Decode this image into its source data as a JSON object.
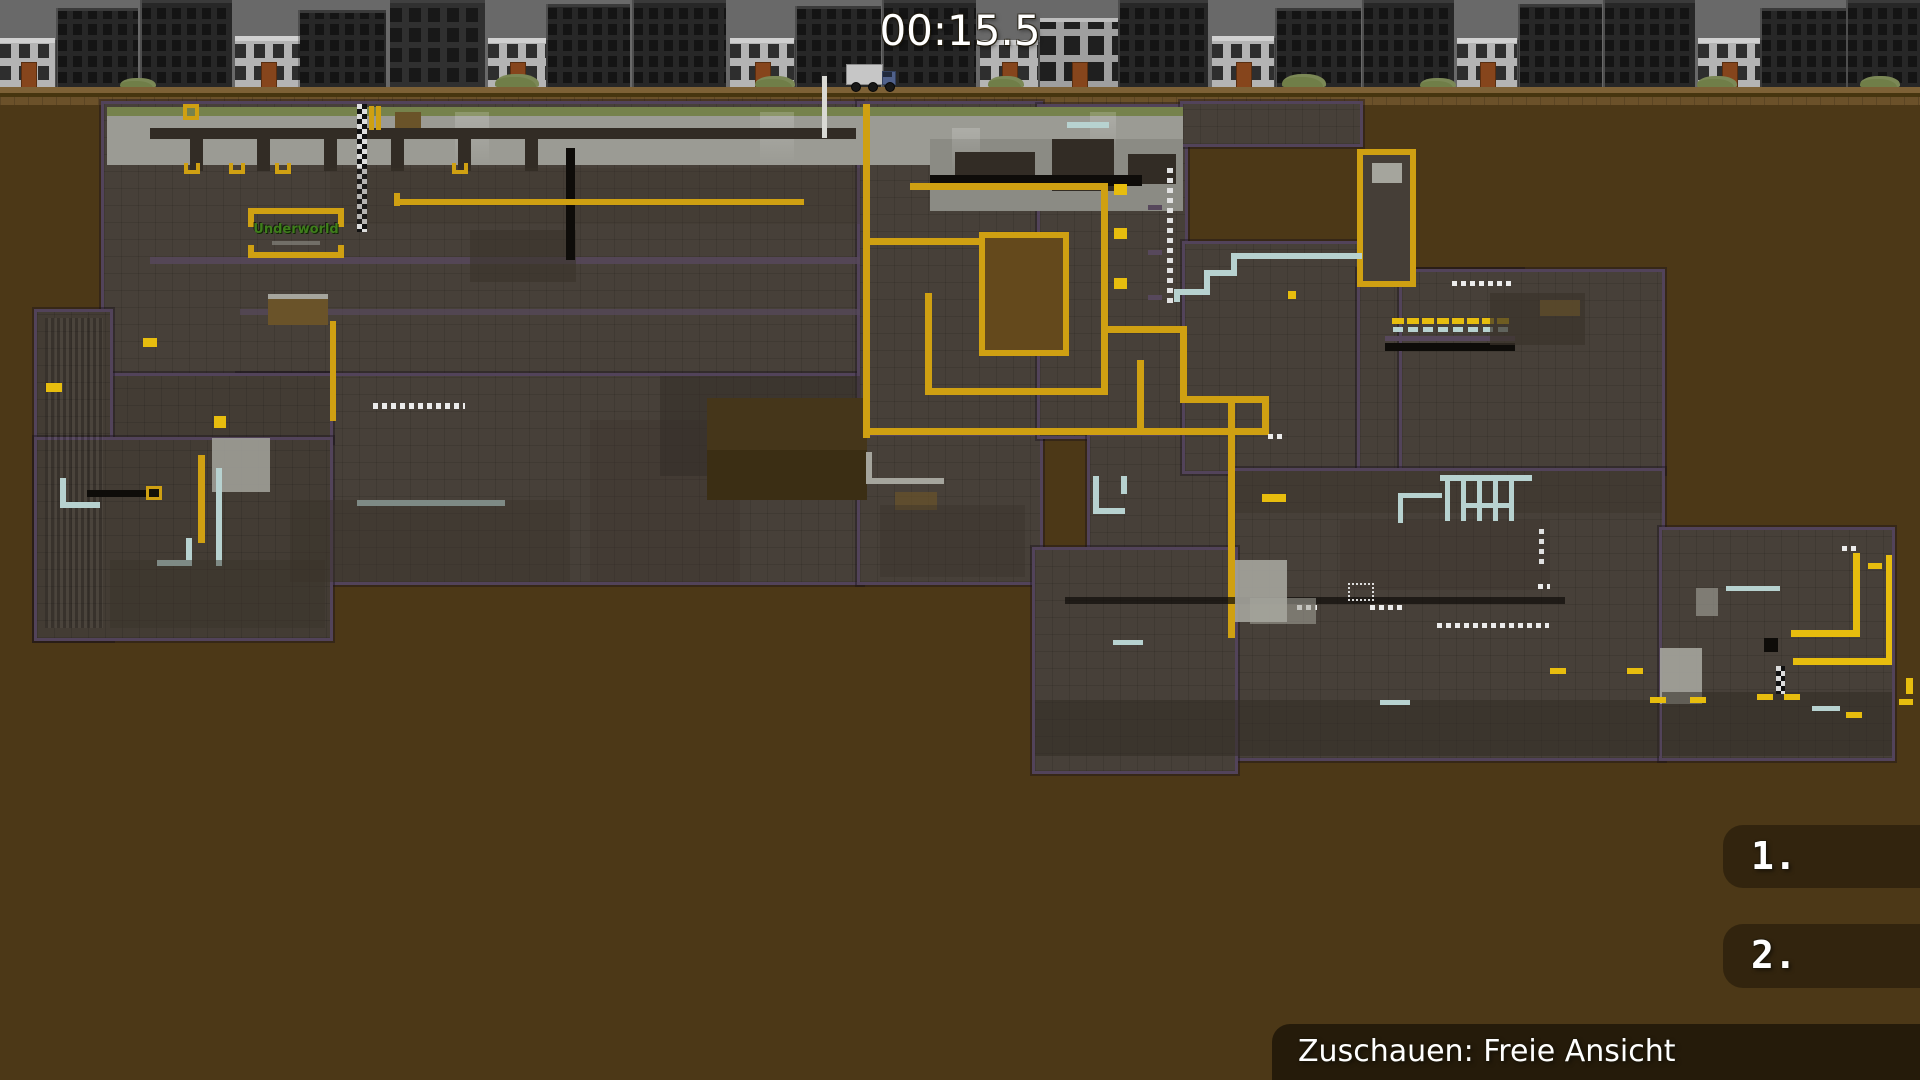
{
  "hud": {
    "timer": "00:15.5",
    "scoreboard": [
      {
        "rank": "1."
      },
      {
        "rank": "2."
      }
    ],
    "spectate_label": "Zuschauen: Freie Ansicht"
  },
  "colors": {
    "background": "#4c3817",
    "sky": "#696969",
    "map_fill": "#474039",
    "map_border": "#52435a",
    "accent_yellow": "#cfa012",
    "pipe_blue": "#b7d2d0",
    "surface_grey": "#9b9b94",
    "sign_green": "#3f7d1c",
    "hud_panel": "rgba(27,19,6,0.52)",
    "text": "#ffffff"
  },
  "map": {
    "sign_text": "Underworld",
    "buildings": [
      [
        0,
        55,
        50,
        "light"
      ],
      [
        58,
        80,
        80,
        "dark"
      ],
      [
        142,
        90,
        88,
        "dark"
      ],
      [
        235,
        66,
        52,
        "light"
      ],
      [
        300,
        86,
        78,
        "dark"
      ],
      [
        390,
        95,
        88,
        "darkwin"
      ],
      [
        488,
        58,
        50,
        "light"
      ],
      [
        548,
        82,
        84,
        "dark"
      ],
      [
        634,
        92,
        88,
        "dark"
      ],
      [
        730,
        64,
        50,
        "light"
      ],
      [
        797,
        84,
        82,
        "dark"
      ],
      [
        884,
        92,
        88,
        "dark"
      ],
      [
        980,
        58,
        48,
        "light"
      ],
      [
        1040,
        78,
        70,
        "light2"
      ],
      [
        1120,
        88,
        88,
        "dark"
      ],
      [
        1212,
        62,
        52,
        "light"
      ],
      [
        1277,
        84,
        80,
        "dark"
      ],
      [
        1364,
        90,
        88,
        "dark"
      ],
      [
        1457,
        60,
        50,
        "light"
      ],
      [
        1520,
        82,
        84,
        "dark"
      ],
      [
        1605,
        90,
        88,
        "dark"
      ],
      [
        1698,
        62,
        50,
        "light"
      ],
      [
        1762,
        84,
        80,
        "dark"
      ],
      [
        1848,
        72,
        88,
        "dark"
      ]
    ],
    "bushes": [
      [
        120,
        36,
        10
      ],
      [
        495,
        44,
        14
      ],
      [
        755,
        40,
        12
      ],
      [
        988,
        36,
        12
      ],
      [
        1282,
        44,
        14
      ],
      [
        1420,
        36,
        10
      ],
      [
        1697,
        40,
        12
      ],
      [
        1860,
        40,
        12
      ]
    ],
    "rects": [
      [
        104,
        104,
        756,
        272,
        "fill b"
      ],
      [
        240,
        376,
        620,
        206,
        "fill b"
      ],
      [
        110,
        376,
        220,
        64,
        "fill2 b"
      ],
      [
        37,
        312,
        73,
        326,
        "fill2 b"
      ],
      [
        37,
        440,
        293,
        198,
        "fill2 b"
      ],
      [
        860,
        104,
        180,
        332,
        "fill b"
      ],
      [
        860,
        436,
        180,
        146,
        "fill b"
      ],
      [
        1040,
        107,
        145,
        329,
        "fill b"
      ],
      [
        1090,
        436,
        145,
        114,
        "fill b"
      ],
      [
        1183,
        104,
        177,
        40,
        "fill b"
      ],
      [
        1185,
        244,
        175,
        227,
        "fill b"
      ],
      [
        1360,
        272,
        160,
        199,
        "fill b"
      ],
      [
        1402,
        272,
        260,
        199,
        "fill b"
      ],
      [
        1235,
        471,
        427,
        287,
        "fill b"
      ],
      [
        1662,
        530,
        230,
        228,
        "fill b"
      ],
      [
        1035,
        550,
        200,
        221,
        "fill b"
      ],
      [
        107,
        107,
        1076,
        58,
        "surface"
      ],
      [
        107,
        107,
        1076,
        9,
        "green"
      ],
      [
        930,
        139,
        253,
        72,
        "surfdim"
      ],
      [
        455,
        112,
        34,
        52,
        "glow"
      ],
      [
        760,
        112,
        34,
        52,
        "glow"
      ],
      [
        952,
        128,
        28,
        46,
        "glow"
      ],
      [
        1090,
        112,
        26,
        40,
        "glow"
      ],
      [
        150,
        128,
        706,
        11,
        "dark2"
      ],
      [
        190,
        139,
        13,
        32,
        "dark2"
      ],
      [
        257,
        139,
        13,
        32,
        "dark2"
      ],
      [
        324,
        139,
        13,
        32,
        "dark2"
      ],
      [
        391,
        139,
        13,
        32,
        "dark2"
      ],
      [
        458,
        139,
        13,
        32,
        "dark2"
      ],
      [
        525,
        139,
        13,
        32,
        "dark2"
      ],
      [
        955,
        152,
        80,
        34,
        "dark2"
      ],
      [
        1052,
        139,
        62,
        52,
        "dark2"
      ],
      [
        1128,
        154,
        48,
        30,
        "dark2"
      ],
      [
        930,
        175,
        212,
        11,
        "black"
      ],
      [
        357,
        104,
        10,
        128,
        "checker"
      ],
      [
        369,
        106,
        5,
        24,
        "yellow"
      ],
      [
        376,
        106,
        5,
        24,
        "yellow"
      ],
      [
        822,
        76,
        5,
        62,
        "white2"
      ],
      [
        183,
        104,
        16,
        16,
        "ysq"
      ],
      [
        395,
        112,
        26,
        16,
        "dirt2"
      ],
      [
        1067,
        122,
        42,
        6,
        "blue"
      ],
      [
        150,
        257,
        710,
        7,
        "purple2",
        0.85
      ],
      [
        240,
        309,
        620,
        6,
        "purple2",
        0.7
      ],
      [
        330,
        168,
        530,
        56,
        "dark",
        0.25
      ],
      [
        470,
        230,
        106,
        52,
        "dark",
        0.6
      ],
      [
        566,
        148,
        9,
        112,
        "black"
      ],
      [
        184,
        163,
        16,
        11,
        "uhook"
      ],
      [
        229,
        163,
        16,
        11,
        "uhook"
      ],
      [
        275,
        163,
        16,
        11,
        "uhook"
      ],
      [
        452,
        163,
        16,
        11,
        "uhook"
      ],
      [
        394,
        193,
        6,
        13,
        "yellow"
      ],
      [
        394,
        199,
        410,
        6,
        "yellow"
      ],
      [
        248,
        208,
        96,
        6,
        "yellow"
      ],
      [
        248,
        214,
        6,
        13,
        "yellow"
      ],
      [
        338,
        214,
        6,
        13,
        "yellow"
      ],
      [
        248,
        252,
        96,
        6,
        "yellow"
      ],
      [
        248,
        245,
        6,
        7,
        "yellow"
      ],
      [
        338,
        245,
        6,
        7,
        "yellow"
      ],
      [
        272,
        241,
        48,
        4,
        "grey2",
        0.6
      ],
      [
        268,
        294,
        60,
        5,
        "grey"
      ],
      [
        268,
        299,
        60,
        26,
        "dirt2"
      ],
      [
        330,
        321,
        6,
        100,
        "yellow"
      ],
      [
        373,
        403,
        92,
        6,
        "dotH"
      ],
      [
        45,
        318,
        58,
        310,
        "stripes",
        0.8
      ],
      [
        87,
        490,
        64,
        7,
        "black"
      ],
      [
        146,
        486,
        16,
        14,
        "ybox"
      ],
      [
        198,
        455,
        7,
        88,
        "yellow"
      ],
      [
        214,
        416,
        12,
        12,
        "ybright"
      ],
      [
        143,
        338,
        14,
        9,
        "ybright"
      ],
      [
        46,
        383,
        16,
        9,
        "ybright"
      ],
      [
        212,
        438,
        58,
        54,
        "grey",
        0.85
      ],
      [
        216,
        468,
        6,
        98,
        "blue"
      ],
      [
        186,
        538,
        6,
        28,
        "blue"
      ],
      [
        157,
        560,
        35,
        6,
        "blue"
      ],
      [
        357,
        500,
        148,
        6,
        "blue"
      ],
      [
        60,
        478,
        6,
        30,
        "blue"
      ],
      [
        60,
        502,
        40,
        6,
        "blue"
      ],
      [
        110,
        560,
        215,
        68,
        "dark",
        0.45
      ],
      [
        290,
        500,
        280,
        82,
        "dark",
        0.45
      ],
      [
        590,
        420,
        150,
        162,
        "dark",
        0.3
      ],
      [
        660,
        376,
        200,
        100,
        "dark2",
        0.5
      ],
      [
        707,
        398,
        160,
        102,
        "pit"
      ],
      [
        707,
        450,
        160,
        50,
        "pit2"
      ],
      [
        863,
        104,
        7,
        334,
        "yellow"
      ],
      [
        910,
        183,
        198,
        7,
        "yellow"
      ],
      [
        1101,
        183,
        7,
        212,
        "yellow"
      ],
      [
        925,
        388,
        183,
        7,
        "yellow"
      ],
      [
        925,
        293,
        7,
        100,
        "yellow"
      ],
      [
        868,
        238,
        120,
        7,
        "yellow"
      ],
      [
        985,
        238,
        78,
        112,
        "hole"
      ],
      [
        1114,
        184,
        13,
        11,
        "ybright"
      ],
      [
        1114,
        228,
        13,
        11,
        "ybright"
      ],
      [
        1114,
        278,
        13,
        11,
        "ybright"
      ],
      [
        1148,
        205,
        14,
        5,
        "purple2"
      ],
      [
        1148,
        250,
        14,
        5,
        "purple2"
      ],
      [
        1148,
        295,
        14,
        5,
        "purple2"
      ],
      [
        1167,
        167,
        6,
        136,
        "dotV"
      ],
      [
        868,
        428,
        401,
        7,
        "yellow"
      ],
      [
        1228,
        400,
        7,
        238,
        "yellow"
      ],
      [
        1105,
        326,
        82,
        7,
        "yellow"
      ],
      [
        1180,
        326,
        7,
        77,
        "yellow"
      ],
      [
        1180,
        396,
        88,
        7,
        "yellow"
      ],
      [
        1262,
        396,
        7,
        38,
        "yellow"
      ],
      [
        1137,
        360,
        7,
        75,
        "yellow"
      ],
      [
        866,
        452,
        6,
        32,
        "grey"
      ],
      [
        866,
        478,
        78,
        6,
        "grey"
      ],
      [
        895,
        492,
        42,
        18,
        "dirt2",
        0.7
      ],
      [
        880,
        505,
        145,
        72,
        "dark",
        0.4
      ],
      [
        1363,
        155,
        47,
        126,
        "tower"
      ],
      [
        1372,
        163,
        30,
        20,
        "grey"
      ],
      [
        1237,
        253,
        125,
        6,
        "blue"
      ],
      [
        1231,
        253,
        6,
        22,
        "blue"
      ],
      [
        1204,
        270,
        33,
        6,
        "blue"
      ],
      [
        1204,
        270,
        6,
        24,
        "blue"
      ],
      [
        1174,
        289,
        36,
        6,
        "blue"
      ],
      [
        1174,
        289,
        6,
        13,
        "blue"
      ],
      [
        1288,
        291,
        8,
        8,
        "ybright"
      ],
      [
        1392,
        318,
        12,
        6,
        "ybright"
      ],
      [
        1407,
        318,
        12,
        6,
        "ybright"
      ],
      [
        1422,
        318,
        12,
        6,
        "ybright"
      ],
      [
        1437,
        318,
        12,
        6,
        "ybright"
      ],
      [
        1452,
        318,
        12,
        6,
        "ybright"
      ],
      [
        1467,
        318,
        12,
        6,
        "ybright"
      ],
      [
        1482,
        318,
        12,
        6,
        "ybright"
      ],
      [
        1497,
        318,
        12,
        6,
        "ybright"
      ],
      [
        1393,
        327,
        10,
        5,
        "blue"
      ],
      [
        1408,
        327,
        10,
        5,
        "blue"
      ],
      [
        1423,
        327,
        10,
        5,
        "blue"
      ],
      [
        1438,
        327,
        10,
        5,
        "blue"
      ],
      [
        1453,
        327,
        10,
        5,
        "blue"
      ],
      [
        1468,
        327,
        10,
        5,
        "blue"
      ],
      [
        1483,
        327,
        10,
        5,
        "blue"
      ],
      [
        1498,
        327,
        10,
        5,
        "blue"
      ],
      [
        1385,
        336,
        130,
        5,
        "purple2"
      ],
      [
        1385,
        343,
        130,
        8,
        "black"
      ],
      [
        1452,
        281,
        62,
        5,
        "dotH"
      ],
      [
        1490,
        293,
        95,
        52,
        "dark",
        0.7
      ],
      [
        1540,
        300,
        40,
        16,
        "dirt2",
        0.6
      ],
      [
        1235,
        471,
        427,
        42,
        "dark",
        0.45
      ],
      [
        1340,
        520,
        210,
        70,
        "dark",
        0.3
      ],
      [
        1065,
        597,
        500,
        7,
        "black",
        0.7
      ],
      [
        1437,
        623,
        112,
        5,
        "dotH"
      ],
      [
        1297,
        605,
        20,
        5,
        "dotH"
      ],
      [
        1370,
        605,
        32,
        5,
        "dotH"
      ],
      [
        1539,
        528,
        5,
        36,
        "dotV"
      ],
      [
        1842,
        546,
        14,
        5,
        "dotH"
      ],
      [
        1538,
        584,
        12,
        5,
        "dotH"
      ],
      [
        1268,
        434,
        16,
        5,
        "dotH"
      ],
      [
        1235,
        560,
        52,
        62,
        "grey",
        0.9
      ],
      [
        1250,
        598,
        66,
        26,
        "grey",
        0.55
      ],
      [
        1660,
        648,
        42,
        56,
        "grey",
        0.9
      ],
      [
        1696,
        588,
        22,
        28,
        "grey",
        0.6
      ],
      [
        1035,
        700,
        625,
        56,
        "dark2",
        0.55
      ],
      [
        1662,
        692,
        230,
        64,
        "dark2",
        0.55
      ],
      [
        1776,
        666,
        9,
        28,
        "checker"
      ],
      [
        1853,
        553,
        7,
        84,
        "ybright"
      ],
      [
        1791,
        630,
        69,
        7,
        "ybright"
      ],
      [
        1886,
        555,
        6,
        110,
        "ybright"
      ],
      [
        1793,
        658,
        99,
        7,
        "ybright"
      ],
      [
        1550,
        668,
        16,
        6,
        "ybright"
      ],
      [
        1627,
        668,
        16,
        6,
        "ybright"
      ],
      [
        1650,
        697,
        16,
        6,
        "ybright"
      ],
      [
        1690,
        697,
        16,
        6,
        "ybright"
      ],
      [
        1757,
        694,
        16,
        6,
        "ybright"
      ],
      [
        1784,
        694,
        16,
        6,
        "ybright"
      ],
      [
        1846,
        712,
        16,
        6,
        "ybright"
      ],
      [
        1899,
        699,
        14,
        6,
        "ybright"
      ],
      [
        1906,
        678,
        7,
        16,
        "ybright"
      ],
      [
        1868,
        563,
        14,
        6,
        "ybright"
      ],
      [
        1726,
        586,
        54,
        5,
        "blue"
      ],
      [
        1812,
        706,
        28,
        5,
        "blue"
      ],
      [
        1380,
        700,
        30,
        5,
        "blue"
      ],
      [
        1113,
        640,
        30,
        5,
        "blue"
      ],
      [
        1440,
        475,
        92,
        6,
        "blue"
      ],
      [
        1445,
        481,
        5,
        40,
        "blue"
      ],
      [
        1461,
        481,
        5,
        40,
        "blue"
      ],
      [
        1477,
        481,
        5,
        40,
        "blue"
      ],
      [
        1493,
        481,
        5,
        40,
        "blue"
      ],
      [
        1509,
        481,
        5,
        40,
        "blue"
      ],
      [
        1461,
        503,
        53,
        5,
        "blue"
      ],
      [
        1398,
        493,
        44,
        5,
        "blue"
      ],
      [
        1398,
        493,
        5,
        30,
        "blue"
      ],
      [
        1764,
        638,
        14,
        14,
        "black"
      ],
      [
        1348,
        583,
        26,
        18,
        "frame"
      ],
      [
        1262,
        494,
        24,
        8,
        "ybright"
      ],
      [
        1093,
        476,
        6,
        38,
        "blue"
      ],
      [
        1093,
        508,
        32,
        6,
        "blue"
      ],
      [
        1121,
        476,
        6,
        18,
        "blue"
      ]
    ]
  }
}
